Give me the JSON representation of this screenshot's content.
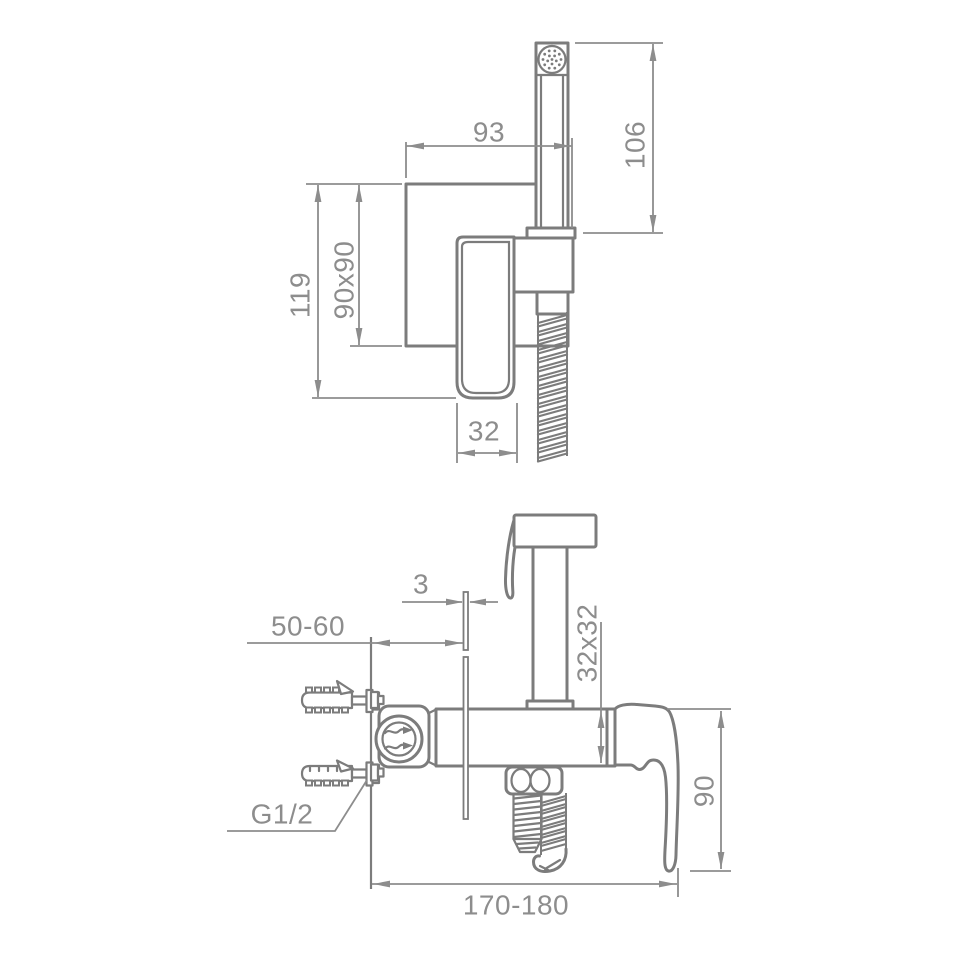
{
  "canvas_background": "#ffffff",
  "colors": {
    "outline": "#7c7c7c",
    "dimension": "#8d8d8d",
    "label_text": "#8d8d8d"
  },
  "diagram": {
    "front": {
      "labels": {
        "plate_to_hose_width": "93",
        "handset_height": "106",
        "overall_height": "119",
        "plate_size": "90x90",
        "spout_width": "32"
      }
    },
    "side": {
      "labels": {
        "plate_thickness": "3",
        "concealed_depth": "50-60",
        "handset_cross_section": "32x32",
        "drop_height": "90",
        "overall_length": "170-180",
        "thread": "G1/2"
      }
    }
  }
}
